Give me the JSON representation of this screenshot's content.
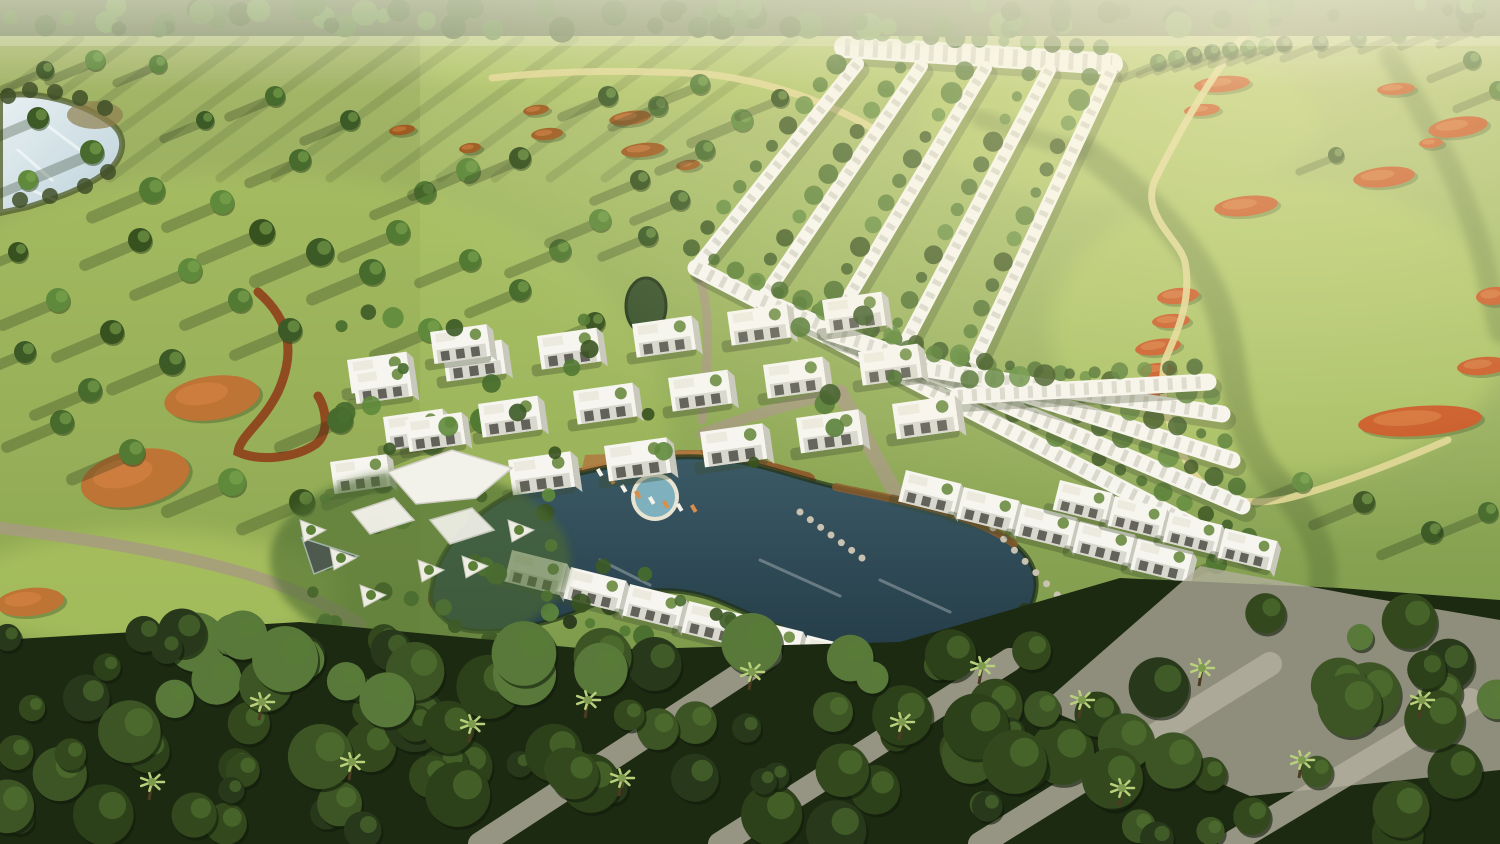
{
  "scene": {
    "size": {
      "w": 1500,
      "h": 844
    },
    "seed": 11,
    "palette": {
      "grass_top": "#b6c478",
      "grass_mid": "#9cb45e",
      "grass_low": "#7c9a4b",
      "grass_dark": "#6f8f44",
      "fairway_bright": "#b8cf66",
      "rough_dark": "#5d7438",
      "tree_greens": [
        "#3c5a26",
        "#466b2c",
        "#527a33",
        "#5f8a3c",
        "#38521f"
      ],
      "tree_highlight": "#82aa52",
      "band_dark": "#1c2a12",
      "band_greens": [
        "#2c4019",
        "#33491d",
        "#3d5524",
        "#27391a",
        "#58793a"
      ],
      "palm_light": "#b9d07c",
      "shadow": "#243417",
      "water_lake_light": "#e8f0f2",
      "water_lake_deep": "#bcd2da",
      "water_pool_top": "#3b5a66",
      "water_pool_deep": "#243c47",
      "water_pool_light": "#7fb0bd",
      "deck": "#8f5c2c",
      "deck_light": "#b07c42",
      "bunker_orange": "#c7511d",
      "bunker_sandy": "#bd7434",
      "bunker_brown": "#9c5a1f",
      "path_yellow": "#e0d693",
      "path_red": "#8f3f1b",
      "road_gray": "#a79a82",
      "gravel": "#b5b0a0",
      "villa_white": "#f6f5ef",
      "villa_face": "#d9d8cf",
      "villa_side": "#c9c8bd",
      "villa_glass": "#62625a",
      "villa_roofdeck": "#eceade",
      "villa_roofgreen": "#69893f",
      "villa_shadow": "#3c4a2c",
      "canopy_white": "#f2f1ea",
      "haze": "#fff6cf",
      "top_band_base": "#57683c"
    },
    "lake": {
      "path": "M0,96 C38,90 82,102 112,124 C130,139 122,162 104,174 C78,192 56,198 28,207 L0,213 Z",
      "reed_patch": [
        95,
        115,
        28,
        14
      ],
      "sparkles": [
        [
          18,
          150,
          52,
          180
        ],
        [
          40,
          120,
          80,
          150
        ],
        [
          20,
          185,
          55,
          200
        ]
      ]
    },
    "mini_pond": {
      "cx": 646,
      "cy": 306,
      "rx": 20,
      "ry": 28
    },
    "fairways": [
      [
        1280,
        330,
        230,
        150,
        0.5
      ],
      [
        1120,
        120,
        200,
        80,
        0.45
      ],
      [
        700,
        60,
        280,
        50,
        0.4
      ],
      [
        250,
        430,
        420,
        260,
        0.3
      ],
      [
        150,
        590,
        190,
        60,
        0.5
      ]
    ],
    "rough_paths": [
      {
        "d": "M1085,150 C1150,200 1192,242 1216,300 C1240,360 1228,422 1268,472 C1298,506 1330,542 1322,592",
        "w": 28,
        "o": 0.45
      },
      {
        "d": "M1390,55 C1420,110 1452,162 1472,222 C1486,262 1492,302 1500,332",
        "w": 22,
        "o": 0.4
      },
      {
        "d": "M980,118 C1030,138 1062,146 1085,150",
        "w": 18,
        "o": 0.35
      }
    ],
    "streaks": {
      "n": 14,
      "x0": 80,
      "dxs": 55,
      "y": 38,
      "len_x": -190,
      "len_y": 140,
      "w": 9,
      "o": 0.13
    },
    "bunkers": {
      "sandy": [
        [
          212,
          398,
          48,
          22,
          -8
        ],
        [
          135,
          478,
          55,
          28,
          -12
        ],
        [
          30,
          602,
          34,
          14,
          -6
        ]
      ],
      "brown": [
        [
          630,
          118,
          21,
          7,
          -8
        ],
        [
          643,
          150,
          22,
          7,
          -6
        ],
        [
          536,
          110,
          13,
          5,
          -8
        ],
        [
          547,
          134,
          16,
          6,
          -6
        ],
        [
          402,
          130,
          13,
          5,
          -8
        ],
        [
          470,
          148,
          11,
          5,
          -8
        ],
        [
          688,
          165,
          12,
          5,
          -8
        ]
      ],
      "orange": [
        [
          1178,
          296,
          21,
          8,
          -6
        ],
        [
          1171,
          321,
          19,
          7,
          -4
        ],
        [
          1158,
          347,
          23,
          8,
          -8
        ],
        [
          1157,
          370,
          18,
          7,
          -5
        ],
        [
          1149,
          394,
          16,
          6,
          -5
        ],
        [
          1222,
          84,
          28,
          8,
          -5
        ],
        [
          1202,
          110,
          18,
          6,
          -5
        ],
        [
          1396,
          89,
          19,
          6,
          -4
        ],
        [
          1458,
          127,
          30,
          10,
          -8
        ],
        [
          1431,
          143,
          12,
          5,
          -5
        ],
        [
          1384,
          177,
          31,
          10,
          -6
        ],
        [
          1246,
          206,
          32,
          10,
          -6
        ],
        [
          1494,
          296,
          18,
          9,
          -5
        ],
        [
          1483,
          366,
          26,
          9,
          -5
        ],
        [
          1420,
          421,
          62,
          15,
          -4
        ]
      ]
    },
    "yellow_paths": [
      "M1247,32 C1215,70 1185,120 1155,180 C1140,215 1180,240 1185,262 C1192,300 1178,330 1165,360 C1158,390 1168,430 1190,468 C1210,500 1250,510 1300,495 C1360,478 1420,452 1448,440",
      "M492,78 C560,70 640,70 706,74 C760,80 820,98 872,128"
    ],
    "red_trail": "M258,292 C290,320 296,352 278,392 C262,424 240,436 238,452 C260,462 296,458 316,444 C330,432 326,408 318,396",
    "gray_paths": [
      {
        "d": "M0,528 C80,538 170,552 240,572 C290,586 330,606 360,624",
        "w": 12
      },
      {
        "d": "M840,392 C862,432 884,472 906,512 C926,546 932,592 936,642",
        "w": 15
      },
      {
        "d": "M702,434 C748,416 796,402 842,392",
        "w": 11
      },
      {
        "d": "M698,272 C712,312 708,362 702,420",
        "w": 9
      }
    ],
    "field_trees": [
      [
        38,
        118,
        11
      ],
      [
        92,
        152,
        12
      ],
      [
        152,
        190,
        13
      ],
      [
        222,
        202,
        12
      ],
      [
        262,
        232,
        13
      ],
      [
        320,
        252,
        14
      ],
      [
        372,
        272,
        13
      ],
      [
        425,
        192,
        11
      ],
      [
        468,
        170,
        12
      ],
      [
        520,
        158,
        11
      ],
      [
        608,
        96,
        10
      ],
      [
        658,
        106,
        10
      ],
      [
        700,
        84,
        10
      ],
      [
        742,
        120,
        11
      ],
      [
        780,
        98,
        9
      ],
      [
        205,
        120,
        9
      ],
      [
        275,
        96,
        10
      ],
      [
        158,
        64,
        9
      ],
      [
        95,
        60,
        10
      ],
      [
        45,
        70,
        9
      ],
      [
        350,
        120,
        10
      ],
      [
        300,
        160,
        11
      ],
      [
        398,
        232,
        12
      ],
      [
        58,
        300,
        12
      ],
      [
        112,
        332,
        12
      ],
      [
        172,
        362,
        13
      ],
      [
        62,
        422,
        12
      ],
      [
        132,
        452,
        13
      ],
      [
        232,
        482,
        14
      ],
      [
        302,
        502,
        13
      ],
      [
        382,
        480,
        12
      ],
      [
        432,
        442,
        12
      ],
      [
        482,
        420,
        12
      ],
      [
        28,
        180,
        10
      ],
      [
        18,
        252,
        10
      ],
      [
        25,
        352,
        11
      ],
      [
        90,
        390,
        12
      ],
      [
        240,
        300,
        12
      ],
      [
        190,
        270,
        12
      ],
      [
        140,
        240,
        12
      ],
      [
        290,
        330,
        12
      ],
      [
        340,
        420,
        13
      ],
      [
        560,
        250,
        11
      ],
      [
        600,
        220,
        11
      ],
      [
        640,
        180,
        10
      ],
      [
        680,
        200,
        10
      ],
      [
        520,
        290,
        11
      ],
      [
        470,
        260,
        11
      ],
      [
        430,
        330,
        12
      ],
      [
        595,
        322,
        10
      ],
      [
        648,
        236,
        10
      ],
      [
        705,
        150,
        10
      ],
      [
        1158,
        62,
        8
      ],
      [
        1176,
        58,
        8
      ],
      [
        1194,
        55,
        8
      ],
      [
        1212,
        52,
        8
      ],
      [
        1230,
        50,
        8
      ],
      [
        1248,
        48,
        8
      ],
      [
        1266,
        46,
        8
      ],
      [
        1284,
        44,
        8
      ],
      [
        1320,
        42,
        8
      ],
      [
        1358,
        38,
        8
      ],
      [
        1398,
        34,
        8
      ],
      [
        1438,
        30,
        8
      ],
      [
        1476,
        28,
        8
      ],
      [
        1336,
        155,
        8
      ],
      [
        1472,
        60,
        9
      ],
      [
        1498,
        90,
        9
      ],
      [
        1302,
        482,
        10
      ],
      [
        1364,
        502,
        11
      ],
      [
        1432,
        532,
        11
      ],
      [
        1488,
        512,
        10
      ],
      [
        1216,
        562,
        10
      ],
      [
        1266,
        592,
        10
      ]
    ],
    "chevrons": {
      "top_row": [
        845,
        47,
        1112,
        64,
        22
      ],
      "upper_arms": [
        [
          857,
          64,
          696,
          268
        ],
        [
          921,
          66,
          762,
          300
        ],
        [
          985,
          68,
          828,
          332
        ],
        [
          1049,
          70,
          894,
          364
        ],
        [
          1110,
          72,
          958,
          396
        ]
      ],
      "lower_arms": [
        [
          696,
          268,
          1252,
          556
        ],
        [
          762,
          300,
          1242,
          506
        ],
        [
          828,
          332,
          1232,
          460
        ],
        [
          894,
          364,
          1222,
          414
        ],
        [
          958,
          396,
          1208,
          382
        ]
      ],
      "arm_w": 17,
      "upper_w": 14
    },
    "villa_rows": [
      {
        "x": 822,
        "y": 300,
        "dx": -95,
        "dy": 12,
        "n": 6,
        "s": 1.0,
        "rot": -8
      },
      {
        "x": 858,
        "y": 352,
        "dx": -95,
        "dy": 13,
        "n": 6,
        "s": 1.0,
        "rot": -8
      },
      {
        "x": 892,
        "y": 404,
        "dx": -96,
        "dy": 14,
        "n": 5,
        "s": 1.05,
        "rot": -8
      },
      {
        "x": 512,
        "y": 550,
        "dx": 59,
        "dy": 17,
        "n": 7,
        "s": 0.95,
        "rot": 14
      },
      {
        "x": 906,
        "y": 470,
        "dx": 58,
        "dy": 17,
        "n": 5,
        "s": 0.95,
        "rot": 14
      },
      {
        "x": 1060,
        "y": 480,
        "dx": 55,
        "dy": 16,
        "n": 4,
        "s": 0.9,
        "rot": 14
      },
      {
        "x": 430,
        "y": 332,
        "dx": -78,
        "dy": 40,
        "n": 2,
        "s": 0.95,
        "rot": -8
      },
      {
        "x": 405,
        "y": 420,
        "dx": -75,
        "dy": 42,
        "n": 2,
        "s": 0.95,
        "rot": -8
      }
    ],
    "cluster_bush_zones": [
      {
        "x0": 340,
        "y0": 300,
        "x1": 900,
        "y1": 500,
        "n": 26
      },
      {
        "x0": 500,
        "y0": 560,
        "x1": 880,
        "y1": 660,
        "n": 14
      },
      {
        "x0": 300,
        "y0": 470,
        "x1": 560,
        "y1": 640,
        "n": 18
      }
    ],
    "garden": {
      "lawn": [
        420,
        560,
        150,
        90
      ],
      "canopies": [
        "388,472 452,450 512,468 476,498 416,504",
        "352,512 394,498 414,520 370,534",
        "430,520 472,508 494,530 450,544"
      ],
      "mirror_pool": "302,538 358,556 314,574",
      "planters": [
        [
          330,
          548
        ],
        [
          300,
          520
        ],
        [
          360,
          585
        ],
        [
          418,
          560
        ],
        [
          462,
          556
        ],
        [
          508,
          520
        ]
      ]
    },
    "lagoon": {
      "pool_path": "M432,588 C438,540 492,492 558,478 C610,467 648,455 700,457 C756,460 788,476 836,487 C906,502 972,512 1014,544 C1048,570 1042,612 1002,636 C958,661 898,666 846,653 C800,642 762,618 716,600 C668,582 622,592 578,611 C544,626 472,642 448,622 C432,609 428,600 432,588 Z",
      "deck_path": "M438,600 C448,548 498,497 562,483 C612,471 650,459 700,460 C744,462 770,473 806,482",
      "deck_east": "M836,487 C906,502 972,512 1014,544",
      "deck_apron": "585,455 700,450 720,480 700,515 640,520 600,500 580,478",
      "small_pool": [
        655,
        497,
        20
      ],
      "loungers": [
        [
          596,
          470
        ],
        [
          608,
          478
        ],
        [
          620,
          486
        ],
        [
          634,
          492
        ],
        [
          648,
          498
        ],
        [
          662,
          502
        ],
        [
          676,
          505
        ],
        [
          690,
          506
        ]
      ],
      "stepping_stones": [
        {
          "x1": 800,
          "y1": 512,
          "x2": 862,
          "y2": 558,
          "n": 7
        },
        {
          "x1": 993,
          "y1": 528,
          "x2": 1068,
          "y2": 606,
          "n": 8
        }
      ],
      "sparkles": [
        [
          760,
          560,
          840,
          596
        ],
        [
          880,
          580,
          950,
          612
        ],
        [
          600,
          560,
          650,
          585
        ]
      ],
      "fringe": [
        [
          455,
          626
        ],
        [
          490,
          640
        ],
        [
          530,
          642
        ],
        [
          570,
          622
        ],
        [
          610,
          606
        ],
        [
          650,
          602
        ],
        [
          695,
          610
        ],
        [
          735,
          622
        ],
        [
          775,
          634
        ],
        [
          815,
          648
        ],
        [
          855,
          658
        ],
        [
          895,
          664
        ],
        [
          935,
          664
        ],
        [
          975,
          652
        ],
        [
          1005,
          640
        ],
        [
          1025,
          610
        ]
      ]
    },
    "band": {
      "edge": "0,640 300,622 600,650 900,642 1120,578 1340,588 1500,600 1500,844 0,844",
      "tree_n": 120,
      "gravel_lines": [
        [
          480,
          844,
          770,
          655
        ],
        [
          720,
          844,
          1010,
          660
        ],
        [
          980,
          844,
          1270,
          664
        ],
        [
          1230,
          844,
          1470,
          700
        ]
      ],
      "gravel_blob": "1040,706 1200,566 1360,596 1500,620 1500,770 1250,796",
      "palms": [
        [
          588,
          700
        ],
        [
          622,
          778
        ],
        [
          902,
          722
        ],
        [
          1082,
          700
        ],
        [
          1302,
          760
        ],
        [
          1422,
          700
        ],
        [
          262,
          702
        ],
        [
          352,
          762
        ],
        [
          152,
          782
        ],
        [
          752,
          672
        ],
        [
          982,
          666
        ],
        [
          1202,
          668
        ],
        [
          472,
          724
        ],
        [
          1122,
          788
        ]
      ]
    },
    "top_band": {
      "h": 36,
      "n": 80
    }
  }
}
